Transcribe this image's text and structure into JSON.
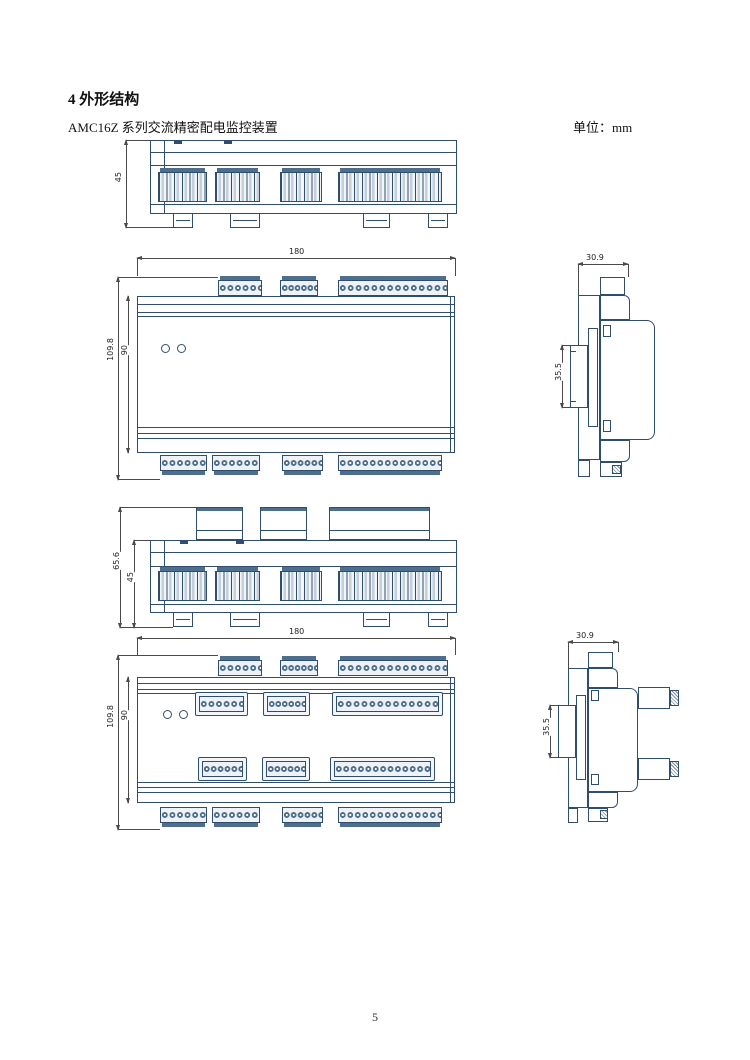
{
  "header": {
    "section_title": "4 外形结构",
    "product_line": "AMC16Z 系列交流精密配电监控装置",
    "unit_label": "单位：mm"
  },
  "page": {
    "number": "5"
  },
  "dimensions": {
    "top_view_height": "45",
    "front_width": "180",
    "front_total_height": "109.8",
    "front_body_height": "90",
    "side_depth": "30.9",
    "side_rail_height": "35.5",
    "top_view_plugs_total_height": "65.6",
    "top_view_plugs_body_height": "45"
  },
  "drawings": {
    "top_view": {
      "terminal_groups": [
        6,
        6,
        6,
        14
      ],
      "mounting_feet": 4
    },
    "front_view": {
      "top_terminal_strips": [
        6,
        6,
        14
      ],
      "bottom_terminal_strips": [
        6,
        6,
        6,
        14
      ],
      "led_count": 2
    },
    "side_view": {
      "din_rail_clip": true
    },
    "top_view_with_plugs": {
      "plug_housings": 3,
      "terminal_groups": [
        6,
        6,
        6,
        14
      ]
    },
    "front_view_with_plugs": {
      "plug_rows": [
        [
          6,
          6,
          13
        ],
        [
          6,
          6,
          13
        ]
      ],
      "led_count": 2
    },
    "side_view_with_plugs": {
      "side_plugs": 2
    }
  }
}
